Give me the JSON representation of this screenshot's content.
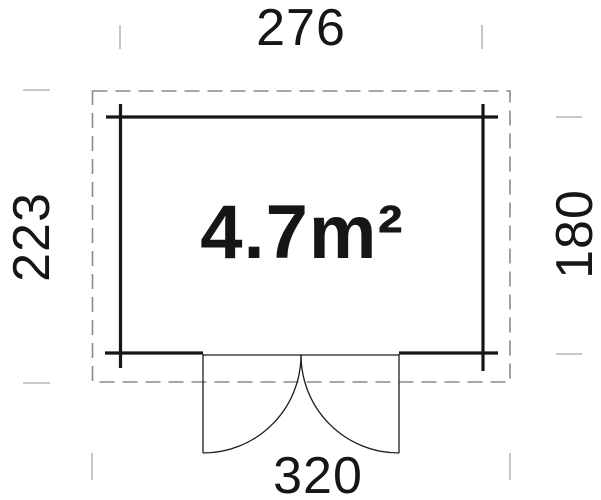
{
  "plan": {
    "area_label": "4.7m²",
    "dimensions": {
      "top": "276",
      "bottom": "320",
      "left": "223",
      "right": "180"
    },
    "colors": {
      "wall": "#161616",
      "roof_outline": "#8a8a8a",
      "door": "#1c1c1c",
      "tick": "#a8a8a8",
      "text": "#161616"
    }
  }
}
